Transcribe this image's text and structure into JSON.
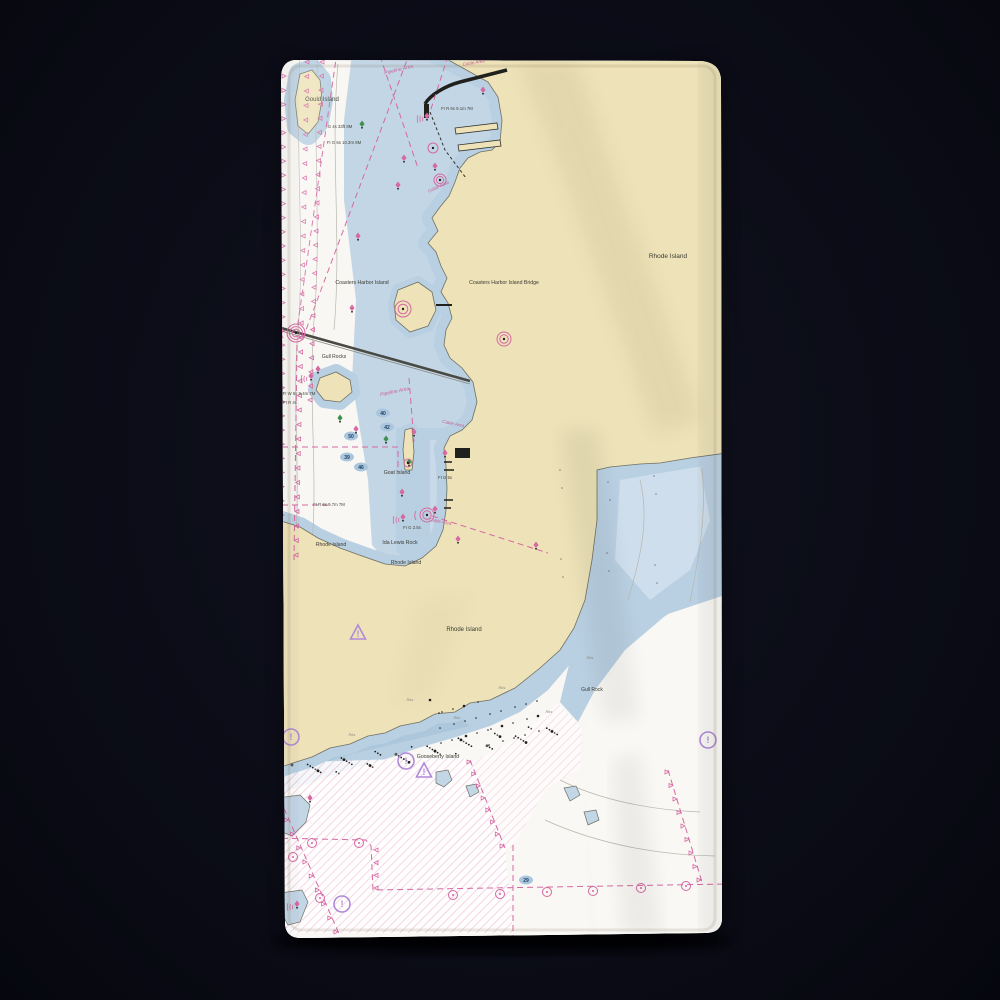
{
  "scene": {
    "background_color": "#0a0b15",
    "product": "towel with nautical chart print"
  },
  "towel": {
    "fabric_color": "#faf8f2",
    "land_color": "#ede2b8",
    "shallow_water_color": "#b9d0e2",
    "mid_water_color": "#cfdeec",
    "chart_magenta": "#d668a2",
    "caution_purple": "#b08ad8",
    "buoy_green": "#3f8f4f"
  },
  "chart": {
    "place_labels": [
      {
        "text": "Gould Island",
        "x": 322,
        "y": 101,
        "size": 6,
        "rotate": 0
      },
      {
        "text": "Coasters Harbor Island",
        "x": 362,
        "y": 284,
        "size": 5.2,
        "rotate": 0
      },
      {
        "text": "Coasters Harbor Island Bridge",
        "x": 504,
        "y": 284,
        "size": 5.2,
        "rotate": 0
      },
      {
        "text": "Rhode Island",
        "x": 668,
        "y": 258,
        "size": 6.5,
        "rotate": 0
      },
      {
        "text": "Goat Island",
        "x": 397,
        "y": 474,
        "size": 5.2,
        "rotate": 0
      },
      {
        "text": "Gull Rocks",
        "x": 334,
        "y": 358,
        "size": 5,
        "rotate": 0
      },
      {
        "text": "Ida Lewis Rock",
        "x": 400,
        "y": 544,
        "size": 5.2,
        "rotate": 0
      },
      {
        "text": "Rhode Island",
        "x": 331,
        "y": 546,
        "size": 5.2,
        "rotate": 0
      },
      {
        "text": "Rhode Island",
        "x": 406,
        "y": 564,
        "size": 5.2,
        "rotate": 0
      },
      {
        "text": "Rhode Island",
        "x": 464,
        "y": 631,
        "size": 6,
        "rotate": 0
      },
      {
        "text": "Gooseberry Island",
        "x": 438,
        "y": 758,
        "size": 5.2,
        "rotate": 0
      },
      {
        "text": "Gull Rock",
        "x": 592,
        "y": 691,
        "size": 5,
        "rotate": 0
      }
    ],
    "area_labels": [
      {
        "text": "Pipeline Area",
        "x": 399,
        "y": 71,
        "size": 5,
        "rotate": -14
      },
      {
        "text": "Cable Area",
        "x": 474,
        "y": 64,
        "size": 4.5,
        "rotate": -10
      },
      {
        "text": "Cable Area",
        "x": 439,
        "y": 188,
        "size": 4.5,
        "rotate": -25
      },
      {
        "text": "Pipeline Area",
        "x": 395,
        "y": 393,
        "size": 5,
        "rotate": -12
      },
      {
        "text": "Cable Area",
        "x": 453,
        "y": 425,
        "size": 4.5,
        "rotate": 12
      },
      {
        "text": "Cable Area",
        "x": 440,
        "y": 523,
        "size": 4.5,
        "rotate": 10
      }
    ],
    "light_labels": [
      {
        "text": "FI R 6s 9.1m 7M",
        "x": 457,
        "y": 110
      },
      {
        "text": "G 4s 33ft 8M",
        "x": 340,
        "y": 128
      },
      {
        "text": "FI G 6s 10.3m 8M",
        "x": 344,
        "y": 144
      },
      {
        "text": "FI W 6s 9.4m 7M",
        "x": 299,
        "y": 395
      },
      {
        "text": "FI R 4s",
        "x": 290,
        "y": 404
      },
      {
        "text": "FI R 6s 9.7m 7M",
        "x": 329,
        "y": 506
      },
      {
        "text": "FI G 5s",
        "x": 445,
        "y": 479
      },
      {
        "text": "FI G 2.5s",
        "x": 412,
        "y": 529
      }
    ],
    "micro_labels": [
      {
        "text": "Rks",
        "x": 410,
        "y": 701
      },
      {
        "text": "Rks",
        "x": 457,
        "y": 719
      },
      {
        "text": "Rks",
        "x": 502,
        "y": 689
      },
      {
        "text": "Rks",
        "x": 549,
        "y": 713
      },
      {
        "text": "Rks",
        "x": 352,
        "y": 736
      },
      {
        "text": "Rks",
        "x": 590,
        "y": 659
      }
    ],
    "depth_soundings": [
      {
        "value": "40",
        "x": 383,
        "y": 413
      },
      {
        "value": "42",
        "x": 387,
        "y": 427
      },
      {
        "value": "50",
        "x": 351,
        "y": 436
      },
      {
        "value": "39",
        "x": 347,
        "y": 457
      },
      {
        "value": "46",
        "x": 361,
        "y": 467
      },
      {
        "value": "29",
        "x": 526,
        "y": 880
      }
    ],
    "buoys": [
      {
        "x": 427,
        "y": 118,
        "color": "magenta",
        "arcs": true
      },
      {
        "x": 483,
        "y": 92,
        "color": "magenta",
        "arcs": false
      },
      {
        "x": 435,
        "y": 168,
        "color": "magenta",
        "arcs": false
      },
      {
        "x": 404,
        "y": 160,
        "color": "magenta",
        "arcs": false
      },
      {
        "x": 362,
        "y": 126,
        "color": "green",
        "arcs": false
      },
      {
        "x": 398,
        "y": 187,
        "color": "magenta",
        "arcs": false
      },
      {
        "x": 358,
        "y": 238,
        "color": "magenta",
        "arcs": false
      },
      {
        "x": 352,
        "y": 310,
        "color": "magenta",
        "arcs": false
      },
      {
        "x": 318,
        "y": 371,
        "color": "magenta",
        "arcs": false
      },
      {
        "x": 311,
        "y": 378,
        "color": "magenta",
        "arcs": true
      },
      {
        "x": 340,
        "y": 420,
        "color": "green",
        "arcs": false
      },
      {
        "x": 356,
        "y": 431,
        "color": "magenta",
        "arcs": false
      },
      {
        "x": 386,
        "y": 441,
        "color": "green",
        "arcs": false
      },
      {
        "x": 414,
        "y": 434,
        "color": "magenta",
        "arcs": false
      },
      {
        "x": 409,
        "y": 464,
        "color": "green",
        "arcs": false
      },
      {
        "x": 402,
        "y": 494,
        "color": "magenta",
        "arcs": false
      },
      {
        "x": 403,
        "y": 519,
        "color": "magenta",
        "arcs": true
      },
      {
        "x": 445,
        "y": 455,
        "color": "magenta",
        "arcs": false
      },
      {
        "x": 435,
        "y": 511,
        "color": "magenta",
        "arcs": false
      },
      {
        "x": 458,
        "y": 541,
        "color": "magenta",
        "arcs": false
      },
      {
        "x": 536,
        "y": 547,
        "color": "magenta",
        "arcs": false
      },
      {
        "x": 310,
        "y": 800,
        "color": "magenta",
        "arcs": false
      },
      {
        "x": 297,
        "y": 906,
        "color": "magenta",
        "arcs": true
      }
    ],
    "ring_marks": [
      {
        "x": 296,
        "y": 333,
        "r": 9,
        "rings": 3,
        "arcs": true
      },
      {
        "x": 504,
        "y": 339,
        "r": 7,
        "rings": 2,
        "arcs": false
      },
      {
        "x": 403,
        "y": 309,
        "r": 8,
        "rings": 2,
        "arcs": false
      },
      {
        "x": 433,
        "y": 148,
        "r": 5,
        "rings": 1,
        "arcs": false
      },
      {
        "x": 440,
        "y": 180,
        "r": 6,
        "rings": 2,
        "arcs": false
      },
      {
        "x": 427,
        "y": 515,
        "r": 7,
        "rings": 2,
        "arcs": true
      },
      {
        "x": 408,
        "y": 463,
        "r": 4,
        "rings": 1,
        "arcs": false
      }
    ],
    "caution_marks": [
      {
        "x": 358,
        "y": 634,
        "kind": "triangle"
      },
      {
        "x": 406,
        "y": 761,
        "kind": "circle"
      },
      {
        "x": 424,
        "y": 772,
        "kind": "triangle"
      },
      {
        "x": 708,
        "y": 740,
        "kind": "circle"
      },
      {
        "x": 342,
        "y": 904,
        "kind": "circle"
      },
      {
        "x": 291,
        "y": 737,
        "kind": "circle"
      }
    ],
    "cable_marks": [
      {
        "x": 312,
        "y": 843
      },
      {
        "x": 359,
        "y": 843
      },
      {
        "x": 293,
        "y": 857
      },
      {
        "x": 453,
        "y": 895
      },
      {
        "x": 500,
        "y": 894
      },
      {
        "x": 547,
        "y": 892
      },
      {
        "x": 593,
        "y": 891
      },
      {
        "x": 641,
        "y": 888
      },
      {
        "x": 686,
        "y": 886
      },
      {
        "x": 320,
        "y": 898
      }
    ]
  }
}
